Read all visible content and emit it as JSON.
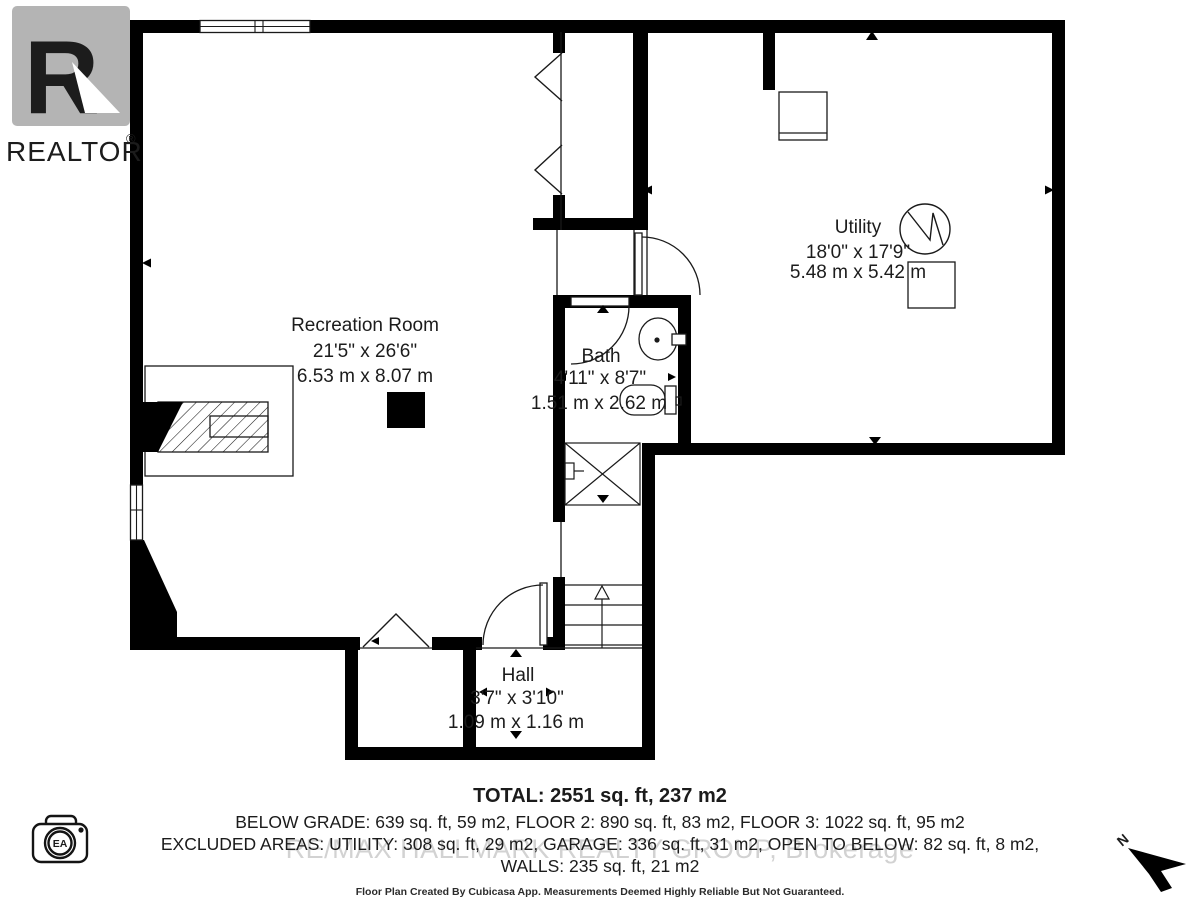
{
  "branding": {
    "realtor": {
      "letter": "R",
      "word": "REALTOR",
      "reg": "®"
    },
    "camera_badge": "EA",
    "north_label": "N",
    "watermark": "RE/MAX HALLMARK REALTY GROUP, Brokerage"
  },
  "rooms": [
    {
      "id": "recreation-room",
      "name": "Recreation Room",
      "imperial": "21'5\" x 26'6\"",
      "metric": "6.53 m x 8.07 m"
    },
    {
      "id": "utility",
      "name": "Utility",
      "imperial": "18'0\" x 17'9\"",
      "metric": "5.48 m x 5.42 m"
    },
    {
      "id": "bath",
      "name": "Bath",
      "imperial": "4'11\" x 8'7\"",
      "metric": "1.51 m x 2.62 m"
    },
    {
      "id": "hall",
      "name": "Hall",
      "imperial": "3'7\" x 3'10\"",
      "metric": "1.09 m x 1.16 m"
    }
  ],
  "summary": {
    "total": "TOTAL: 2551 sq. ft, 237 m2",
    "floors": "BELOW GRADE: 639 sq. ft, 59 m2, FLOOR 2: 890 sq. ft, 83 m2, FLOOR 3: 1022 sq. ft, 95 m2",
    "excluded": "EXCLUDED AREAS: UTILITY: 308 sq. ft, 29 m2, GARAGE: 336 sq. ft, 31 m2, OPEN TO BELOW: 82 sq. ft, 8 m2,",
    "walls": "WALLS: 235 sq. ft, 21 m2",
    "disclaimer": "Floor Plan Created By Cubicasa App. Measurements Deemed Highly Reliable But Not Guaranteed."
  },
  "colors": {
    "wall": "#000000",
    "logo_gray": "#b4b4b4",
    "watermark_gray": "#b5b5b5",
    "text": "#1c1c1c"
  }
}
